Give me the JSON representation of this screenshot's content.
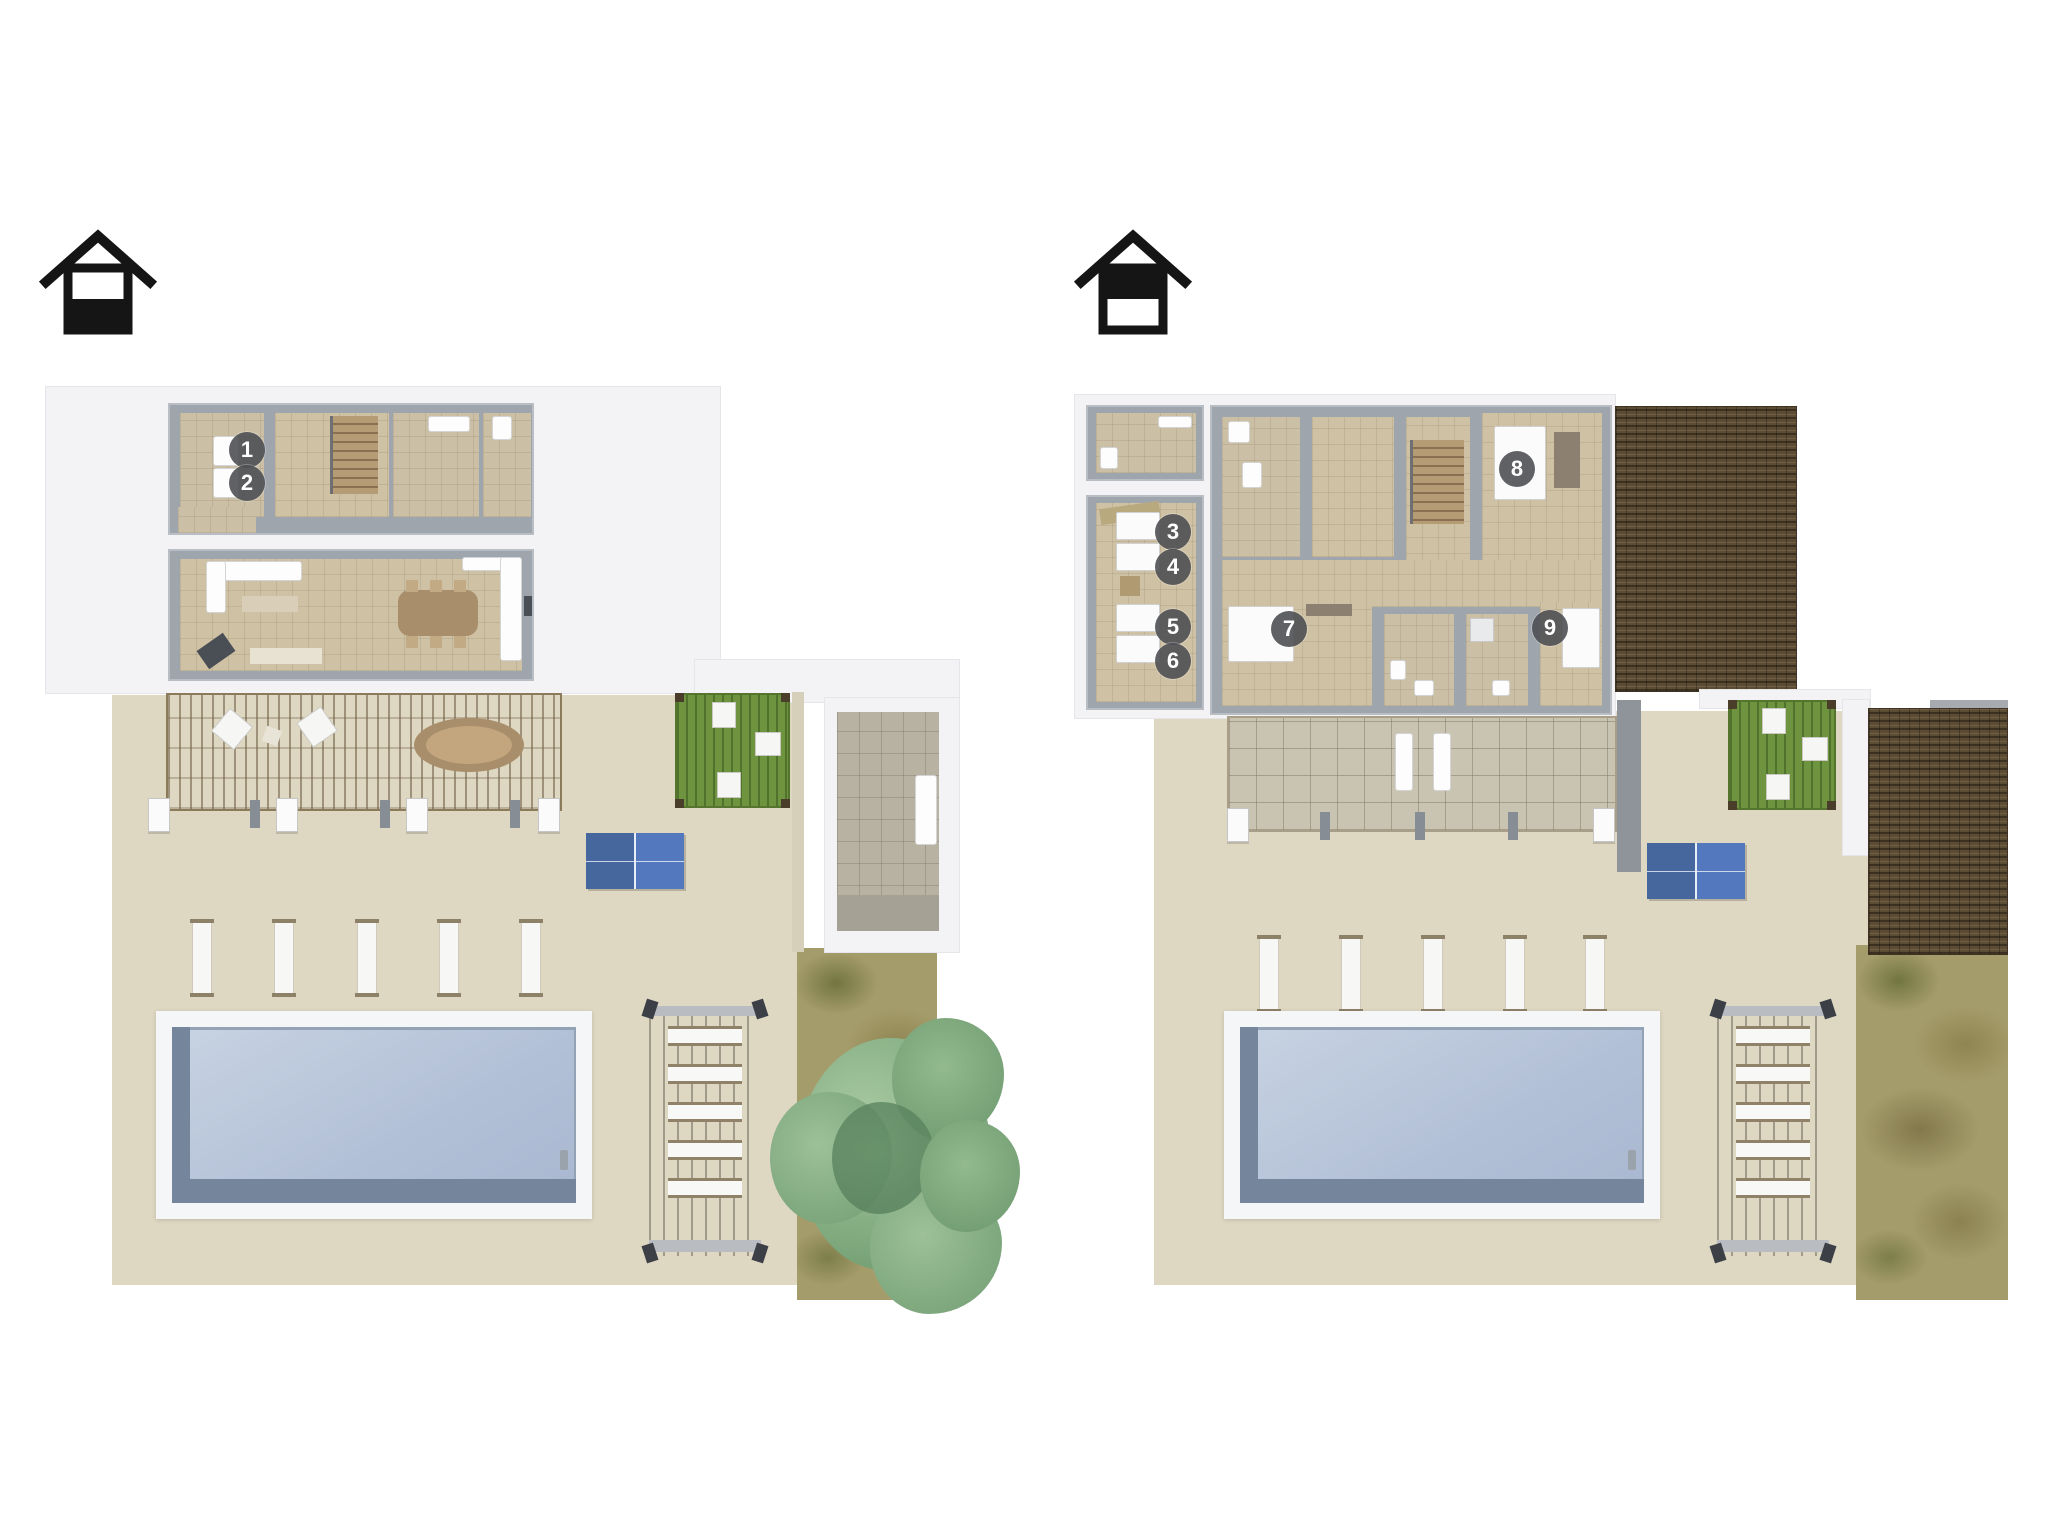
{
  "document": {
    "type": "floor-plan-sheet",
    "background": "#ffffff"
  },
  "plans": [
    {
      "name": "ground-floor-plan",
      "level_icon": {
        "name": "house-ground-floor-icon",
        "filled_half": "bottom"
      },
      "markers": [
        {
          "label": "1",
          "x": 247,
          "y": 450
        },
        {
          "label": "2",
          "x": 247,
          "y": 483
        }
      ]
    },
    {
      "name": "upper-floor-plan",
      "level_icon": {
        "name": "house-upper-floor-icon",
        "filled_half": "top"
      },
      "markers": [
        {
          "label": "3",
          "x": 1173,
          "y": 532
        },
        {
          "label": "4",
          "x": 1173,
          "y": 567
        },
        {
          "label": "5",
          "x": 1173,
          "y": 627
        },
        {
          "label": "6",
          "x": 1173,
          "y": 661
        },
        {
          "label": "7",
          "x": 1289,
          "y": 629
        },
        {
          "label": "8",
          "x": 1517,
          "y": 469
        },
        {
          "label": "9",
          "x": 1550,
          "y": 628
        }
      ]
    }
  ],
  "colors": {
    "marker_bg": "#4e5054",
    "marker_text": "#ffffff",
    "pool_water": "#b0bed6",
    "pool_wall_shadow": "#75859b",
    "table_tennis_blue": "#46679e",
    "patio": "#ded7c2",
    "room_floor": "#cfc1a3",
    "wall_gray": "#9fa5ad",
    "slab_white": "#f3f3f5",
    "roof_tiles_brown": "#5d4c34",
    "lawn_olive": "#a59c6b",
    "tree_green": "#82ab80",
    "pergola_green": "#6f9440",
    "icon_black": "#151515"
  }
}
